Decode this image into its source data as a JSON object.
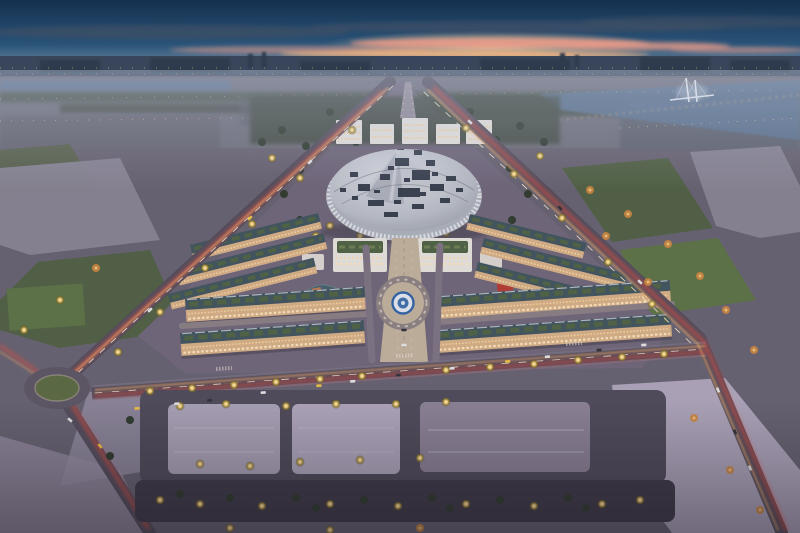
{
  "scene": {
    "title": "aerial-dusk-masterplan-render",
    "time_of_day": "dusk",
    "view": "high-aerial-oblique",
    "landmarks": [
      "sunset-sky",
      "distant-city-skyline",
      "river-with-cable-bridge",
      "suburban-midground",
      "central-exhibition-dome",
      "office-row-behind-dome",
      "central-park-trees",
      "commercial-buildings-pair",
      "shophouse-cluster-left",
      "shophouse-cluster-right",
      "central-axis-plaza",
      "central-roundabout-emblem",
      "left-diagonal-avenue",
      "right-diagonal-avenue",
      "main-boulevard",
      "traffic-light-trails",
      "parking-lots",
      "bottom-tree-row",
      "grass-roundabout-left",
      "green-fields",
      "vacant-plots",
      "small-pond",
      "red-canopy-pavilion"
    ]
  },
  "colors": {
    "sky-top": "#14304e",
    "sky-mid": "#2a5378",
    "sky-horizon": "#8fa3b5",
    "sunset-pink": "#e59a88",
    "sunset-orange": "#f2b480",
    "cloud-dark": "#3f5066",
    "city-silhouette": "#39455a",
    "water": "#5a7390",
    "ground": "#67626f",
    "ground-dev": "#6f6678",
    "road-dark": "#4e4958",
    "road-light": "#8d8598",
    "parking-pale": "#aca4b7",
    "grass": "#4f6040",
    "grass-bright": "#5d7344",
    "tree-dark": "#2e3a2b",
    "tree-lit": "#ffd978",
    "tree-orange": "#d08a3c",
    "dome-base": "#aeb3bb",
    "dome-light": "#d6d9dd",
    "dome-pattern": "#2b3340",
    "dome-rib": "#e6e8ec",
    "building-white": "#e9e5de",
    "facade-warm": "#d8b286",
    "window-warm": "#ffd9a0",
    "roof-teal": "#3f545c",
    "roof-garden": "#4e6342",
    "trail-red": "#ff4a30",
    "trail-amber": "#ffb36b",
    "trail-white": "#ffeccc",
    "emblem-blue": "#2f64a5",
    "plaza-pave": "#c3b29c",
    "car-yellow": "#f2c540",
    "car-white": "#e6e6e6",
    "car-dark": "#2f3136"
  }
}
